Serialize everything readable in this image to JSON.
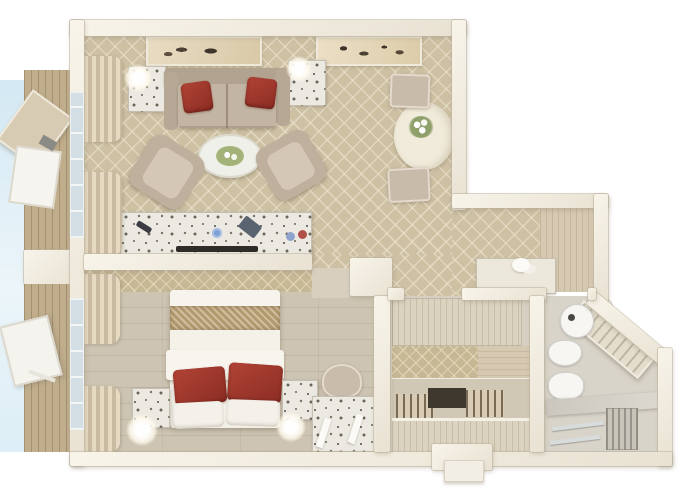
{
  "scene": {
    "kind": "3d-floor-plan-render",
    "view": "top-down",
    "background_color": "#ffffff"
  },
  "palette": {
    "wall": "#f2ede1",
    "wall_edge": "#d7cfbe",
    "carpet": "#cdc0a3",
    "carpet_lattice": "#e0d6bf",
    "bedroom_wallpaper": "#c6b795",
    "wood_floor": "#cec4b3",
    "closet_floor": "#d7d0c2",
    "bathroom_floor": "#d9d4c9",
    "balcony_deck": "#c0ad8c",
    "sky": "#cfe6f2",
    "sofa_beige": "#c3b5a3",
    "cushion_red": "#9d352b",
    "bed_white": "#f2efe7",
    "bed_gold_band": "#b29a70",
    "terrazzo_white": "#ebe9e1",
    "wood_panel": "#d6c9b2",
    "marble": "#cdc9c1",
    "fixture_white": "#f7f6f2",
    "tv_dark": "#2f2c28",
    "lamp_glow": "#ffffff"
  },
  "rooms": {
    "living_room": {
      "name": "living room",
      "furniture": [
        "wall-art-left",
        "wall-art-right",
        "side-table-left",
        "table-lamp-left",
        "side-table-right",
        "table-lamp-right",
        "sofa",
        "red-throw-pillow-left",
        "red-throw-pillow-right",
        "oval-coffee-table",
        "armchair-left",
        "armchair-right",
        "media-console",
        "flat-tv",
        "remote",
        "cups",
        "window-curtains",
        "dining-table",
        "flower-vase",
        "dining-chair-top",
        "dining-chair-bottom"
      ]
    },
    "bedroom": {
      "name": "bedroom",
      "furniture": [
        "double-bed",
        "gold-bed-runner",
        "red-bed-pillow-left",
        "red-bed-pillow-right",
        "white-pillows",
        "nightstand-left",
        "bedside-lamp-left",
        "nightstand-right",
        "bedside-lamp-right",
        "vanity-desk",
        "desk-chair",
        "window-curtains"
      ]
    },
    "hallway": {
      "name": "entry hallway",
      "furniture": [
        "luggage-bench",
        "towel-decoration",
        "wood-wall-paneling"
      ]
    },
    "walk_in_closet": {
      "name": "walk-in closet",
      "furniture": [
        "upper-shelf",
        "back-wallpaper",
        "slatted-shelf-left",
        "slatted-shelf-right",
        "dark-niche",
        "lower-bench",
        "entry-door"
      ]
    },
    "bathroom": {
      "name": "bathroom",
      "furniture": [
        "round-sink",
        "small-basin",
        "toilet",
        "bidet",
        "diagonal-towel-shelf",
        "marble-partition",
        "towel-rail-1",
        "towel-rail-2",
        "towel-radiator"
      ]
    },
    "balcony": {
      "name": "balcony",
      "furniture": [
        "wood-decking",
        "lounge-chair-upper",
        "lounge-chair-lower"
      ]
    }
  }
}
